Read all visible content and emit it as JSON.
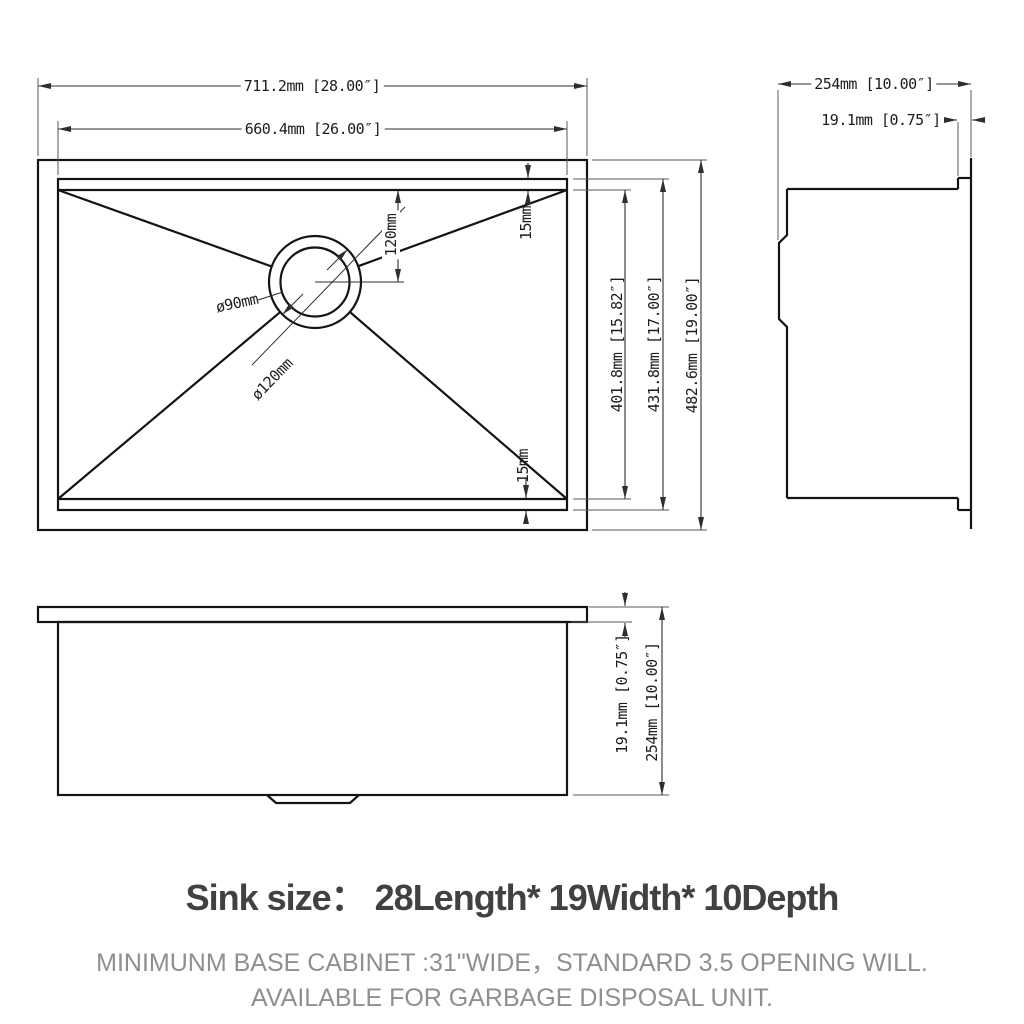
{
  "views": {
    "top": {
      "width_outer": "711.2mm [28.00″]",
      "width_inner": "660.4mm [26.00″]",
      "height_outer": "482.6mm [19.00″]",
      "height_inner": "431.8mm [17.00″]",
      "height_bowl_bottom": "401.8mm [15.82″]",
      "drain_offset": "120mm",
      "corner_top": "15mm",
      "corner_bottom": "15mm",
      "drain_inner_dia": "ø90mm",
      "drain_outer_dia": "ø120mm"
    },
    "side": {
      "depth": "254mm [10.00″]",
      "rim_thickness": "19.1mm [0.75″]"
    },
    "front": {
      "rim_thickness": "19.1mm [0.75″]",
      "depth": "254mm [10.00″]"
    }
  },
  "caption": {
    "title": "Sink size：  28Length* 19Width* 10Depth",
    "subtitle_line1": "MINIMUNM BASE CABINET :31\"WIDE，STANDARD 3.5 OPENING WILL.",
    "subtitle_line2": "AVAILABLE FOR GARBAGE DISPOSAL UNIT."
  },
  "colors": {
    "background": "#ffffff",
    "line": "#141414",
    "dimension": "#2e2e2e",
    "title": "#414141",
    "subtitle": "#8f8f8f"
  }
}
